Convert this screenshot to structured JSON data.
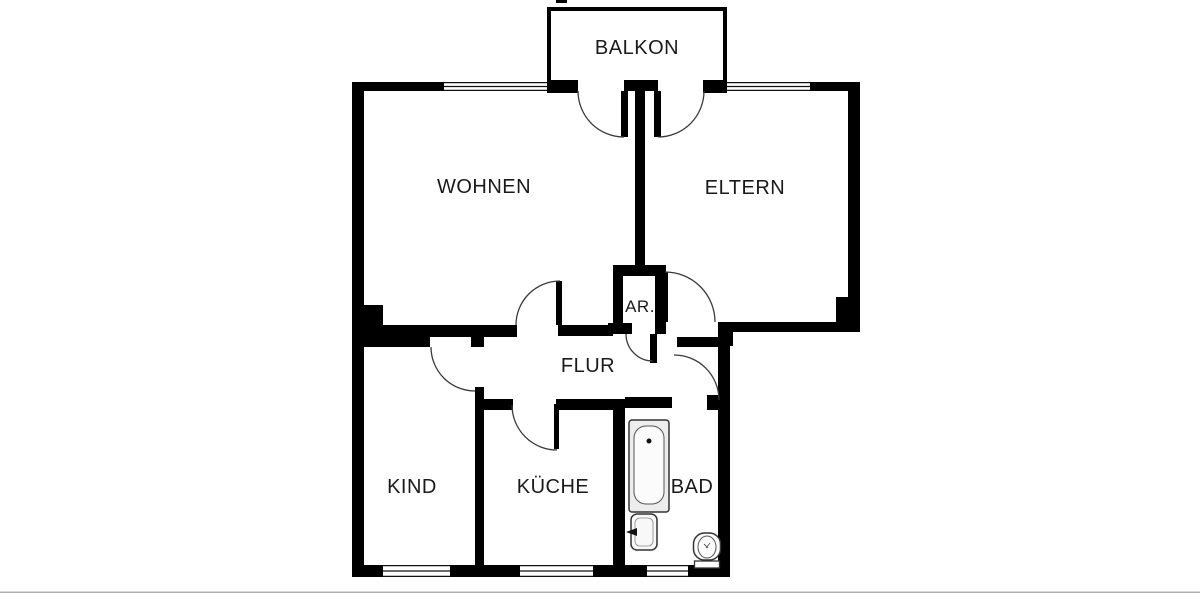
{
  "meta": {
    "title": "apartment floorplan",
    "bg_color": "#ffffff",
    "wall_color": "#000000",
    "arc_color": "#3a3a3a",
    "label_color": "#1a1a1a",
    "border_color": "#b0b0b0"
  },
  "rooms": [
    {
      "id": "balkon",
      "label": "BALKON",
      "cx": 637,
      "cy": 54
    },
    {
      "id": "wohnen",
      "label": "WOHNEN",
      "cx": 484,
      "cy": 193
    },
    {
      "id": "eltern",
      "label": "ELTERN",
      "cx": 745,
      "cy": 194
    },
    {
      "id": "ar",
      "label": "AR.",
      "cx": 640,
      "cy": 312
    },
    {
      "id": "flur",
      "label": "FLUR",
      "cx": 588,
      "cy": 372
    },
    {
      "id": "kind",
      "label": "KIND",
      "cx": 412,
      "cy": 493
    },
    {
      "id": "kueche",
      "label": "KÜCHE",
      "cx": 553,
      "cy": 493
    },
    {
      "id": "bad",
      "label": "BAD",
      "cx": 692,
      "cy": 493
    }
  ],
  "geometry": {
    "walls": [
      [
        352,
        82,
        12,
        495
      ],
      [
        352,
        305,
        31,
        42
      ],
      [
        352,
        82,
        92,
        9
      ],
      [
        547,
        80,
        31,
        13
      ],
      [
        624,
        80,
        34,
        11
      ],
      [
        703,
        80,
        24,
        13
      ],
      [
        810,
        82,
        50,
        9
      ],
      [
        848,
        82,
        12,
        249
      ],
      [
        836,
        297,
        24,
        34
      ],
      [
        718,
        322,
        142,
        10
      ],
      [
        718,
        322,
        15,
        24
      ],
      [
        718,
        346,
        12,
        231
      ],
      [
        352,
        565,
        31,
        12
      ],
      [
        450,
        565,
        70,
        12
      ],
      [
        593,
        565,
        54,
        12
      ],
      [
        688,
        565,
        42,
        12
      ],
      [
        635,
        91,
        10,
        174
      ],
      [
        613,
        265,
        53,
        11
      ],
      [
        613,
        265,
        10,
        60
      ],
      [
        655,
        265,
        11,
        69
      ],
      [
        608,
        323,
        24,
        11
      ],
      [
        364,
        325,
        153,
        12
      ],
      [
        383,
        337,
        47,
        10
      ],
      [
        471,
        337,
        13,
        10
      ],
      [
        558,
        325,
        55,
        11
      ],
      [
        677,
        337,
        41,
        10
      ],
      [
        475,
        387,
        9,
        190
      ],
      [
        484,
        399,
        29,
        11
      ],
      [
        556,
        399,
        62,
        11
      ],
      [
        613,
        399,
        12,
        178
      ],
      [
        625,
        397,
        47,
        11
      ],
      [
        707,
        395,
        11,
        15
      ],
      [
        556,
        0,
        11,
        3
      ]
    ],
    "door_leaves": [
      [
        621,
        91,
        7,
        46
      ],
      [
        654,
        91,
        7,
        46
      ],
      [
        556,
        281,
        6,
        44
      ],
      [
        662,
        272,
        6,
        50
      ],
      [
        650,
        334,
        7,
        29
      ],
      [
        554,
        404,
        5,
        45
      ]
    ],
    "balcony_walls": [
      [
        547,
        7,
        180,
        4
      ],
      [
        547,
        7,
        4,
        75
      ],
      [
        723,
        7,
        4,
        75
      ]
    ],
    "windows": [
      [
        444,
        82,
        103,
        9
      ],
      [
        727,
        82,
        83,
        9
      ],
      [
        383,
        565,
        67,
        12
      ],
      [
        520,
        565,
        73,
        12
      ],
      [
        647,
        565,
        41,
        12
      ]
    ],
    "door_arcs": [
      {
        "cx": 624,
        "cy": 91,
        "r": 46,
        "a0": 180,
        "a1": 90
      },
      {
        "cx": 658,
        "cy": 91,
        "r": 46,
        "a0": 0,
        "a1": 90
      },
      {
        "cx": 560,
        "cy": 325,
        "r": 44,
        "a0": 180,
        "a1": 270
      },
      {
        "cx": 665,
        "cy": 322,
        "r": 50,
        "a0": 270,
        "a1": 360
      },
      {
        "cx": 653,
        "cy": 334,
        "r": 27,
        "a0": 90,
        "a1": 180
      },
      {
        "cx": 475,
        "cy": 347,
        "r": 44,
        "a0": 90,
        "a1": 180
      },
      {
        "cx": 557,
        "cy": 405,
        "r": 45,
        "a0": 90,
        "a1": 180
      },
      {
        "cx": 674,
        "cy": 400,
        "r": 45,
        "a0": 270,
        "a1": 360
      }
    ],
    "fixtures": {
      "bathtub": {
        "x": 629,
        "y": 420,
        "w": 40,
        "h": 92
      },
      "sink": {
        "x": 631,
        "y": 514,
        "w": 26,
        "h": 36
      },
      "toilet": {
        "cx": 707,
        "cy": 550
      }
    },
    "bottom_border_y": 591.5
  }
}
